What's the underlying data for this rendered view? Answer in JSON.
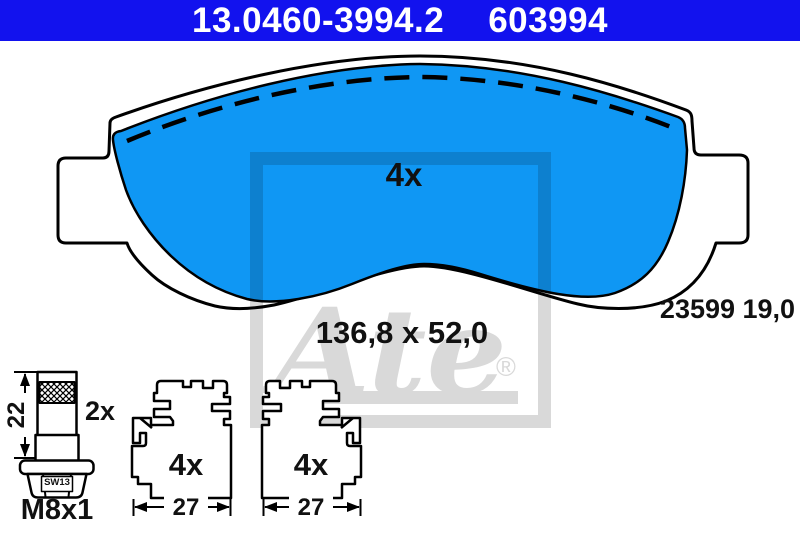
{
  "colors": {
    "header_bg": "#1212ee",
    "header_text": "#ffffff",
    "pad_blue": "#0f97f4",
    "outline": "#000000",
    "watermark_gray": "#d9d9d9",
    "label_text": "#111111"
  },
  "header": {
    "part_number": "13.0460-3994.2",
    "article_number": "603994"
  },
  "pad": {
    "quantity": "4x",
    "dimensions": "136,8 x 52,0",
    "reference": "23599 19,0"
  },
  "bolt": {
    "length": "22",
    "quantity": "2x",
    "thread": "M8x1",
    "wrench_size": "SW13"
  },
  "clips": {
    "left": {
      "quantity": "4x",
      "width": "27"
    },
    "right": {
      "quantity": "4x",
      "width": "27"
    }
  },
  "watermark": {
    "brand": "Ate",
    "registered_mark": "®"
  }
}
